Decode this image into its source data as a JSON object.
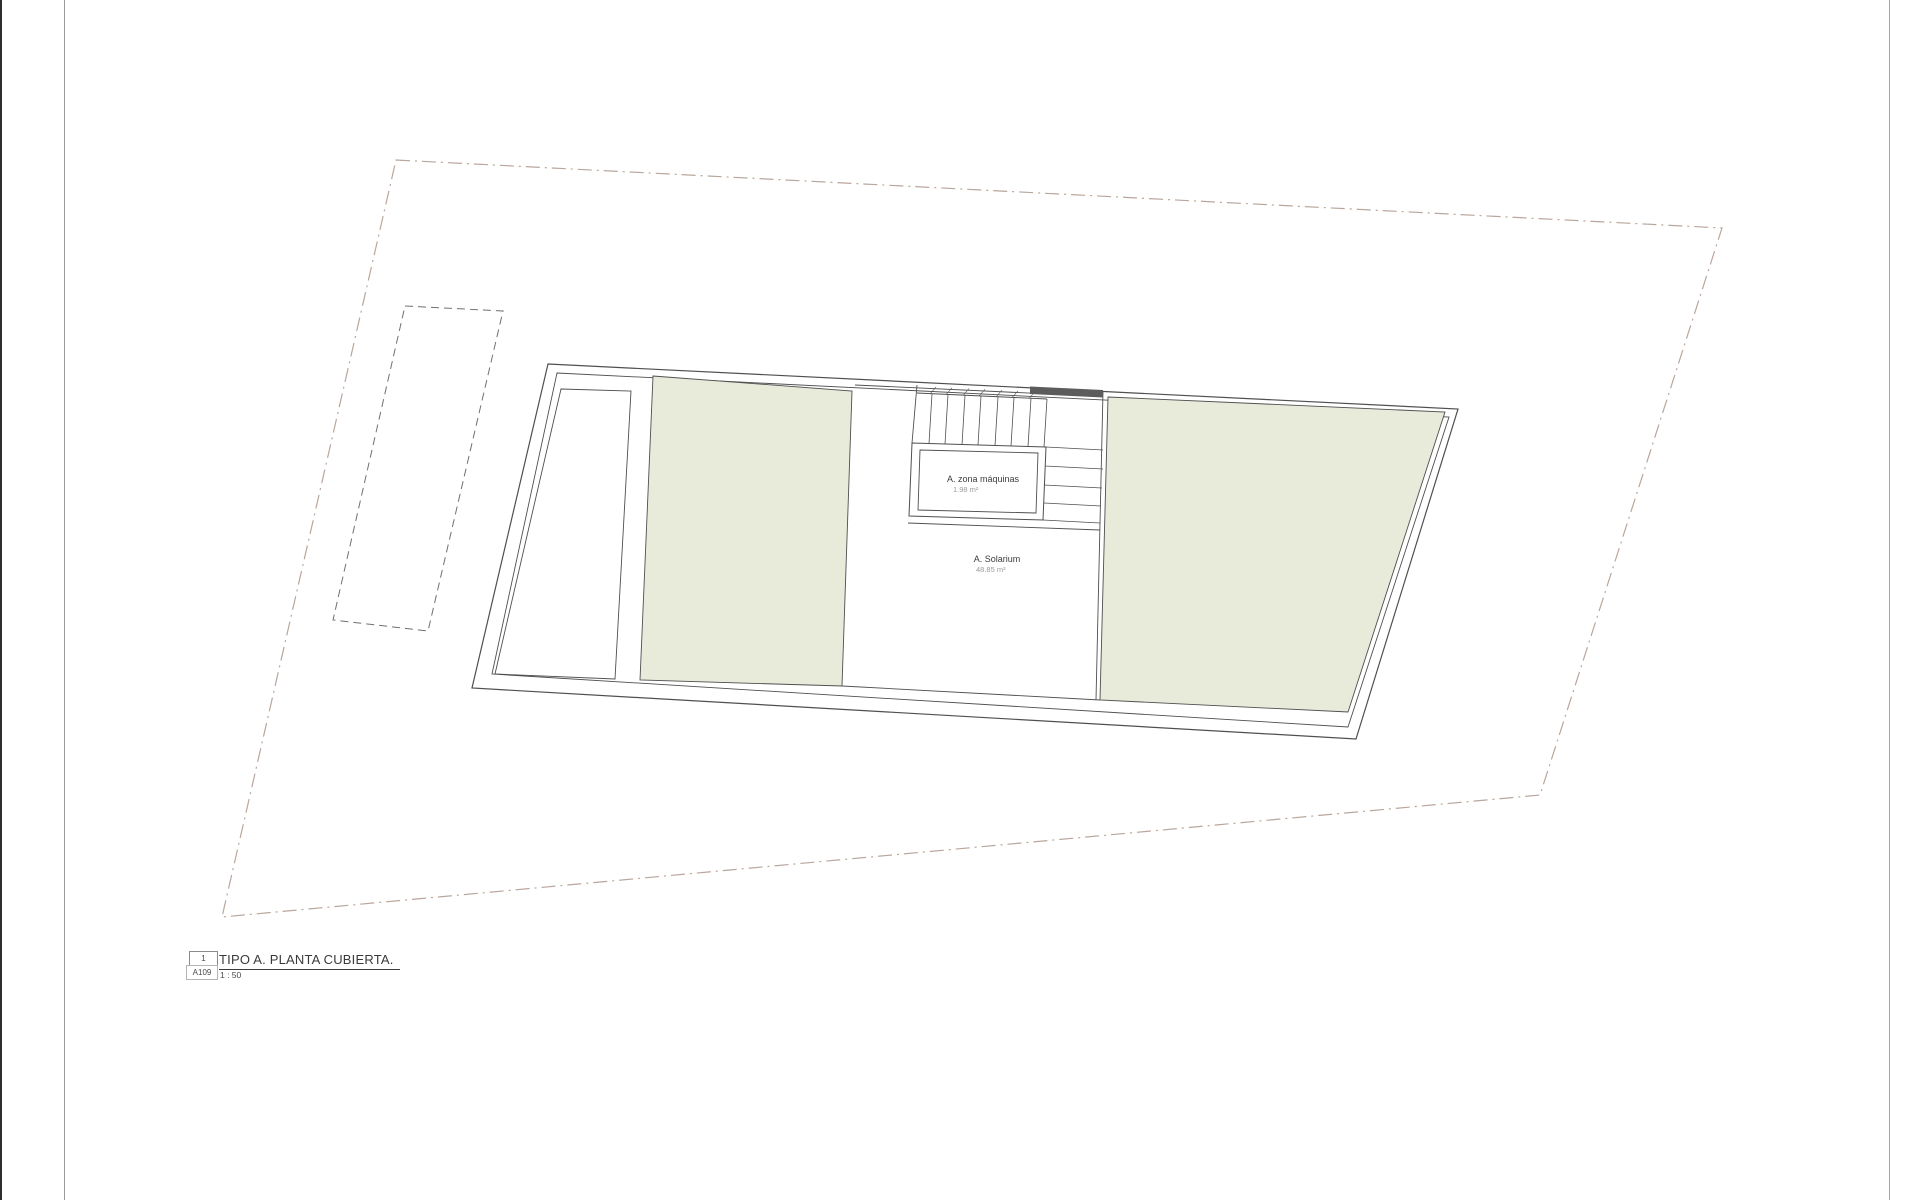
{
  "drawing": {
    "rooms": [
      {
        "name": "A. zona máquinas",
        "area": "1.98 m²"
      },
      {
        "name": "A. Solarium",
        "area": "48.85 m²"
      }
    ],
    "title_block": {
      "detail_number": "1",
      "sheet_code": "A109",
      "title": "TIPO A. PLANTA CUBIERTA.",
      "scale": "1 : 50"
    },
    "colors": {
      "roof_panel_fill": "#e8eada",
      "line": "#4f4f4f",
      "plot_boundary": "#b9a69c",
      "dark_wall_fill": "#5c5c5c",
      "muted_text": "#9b9b9b"
    }
  }
}
